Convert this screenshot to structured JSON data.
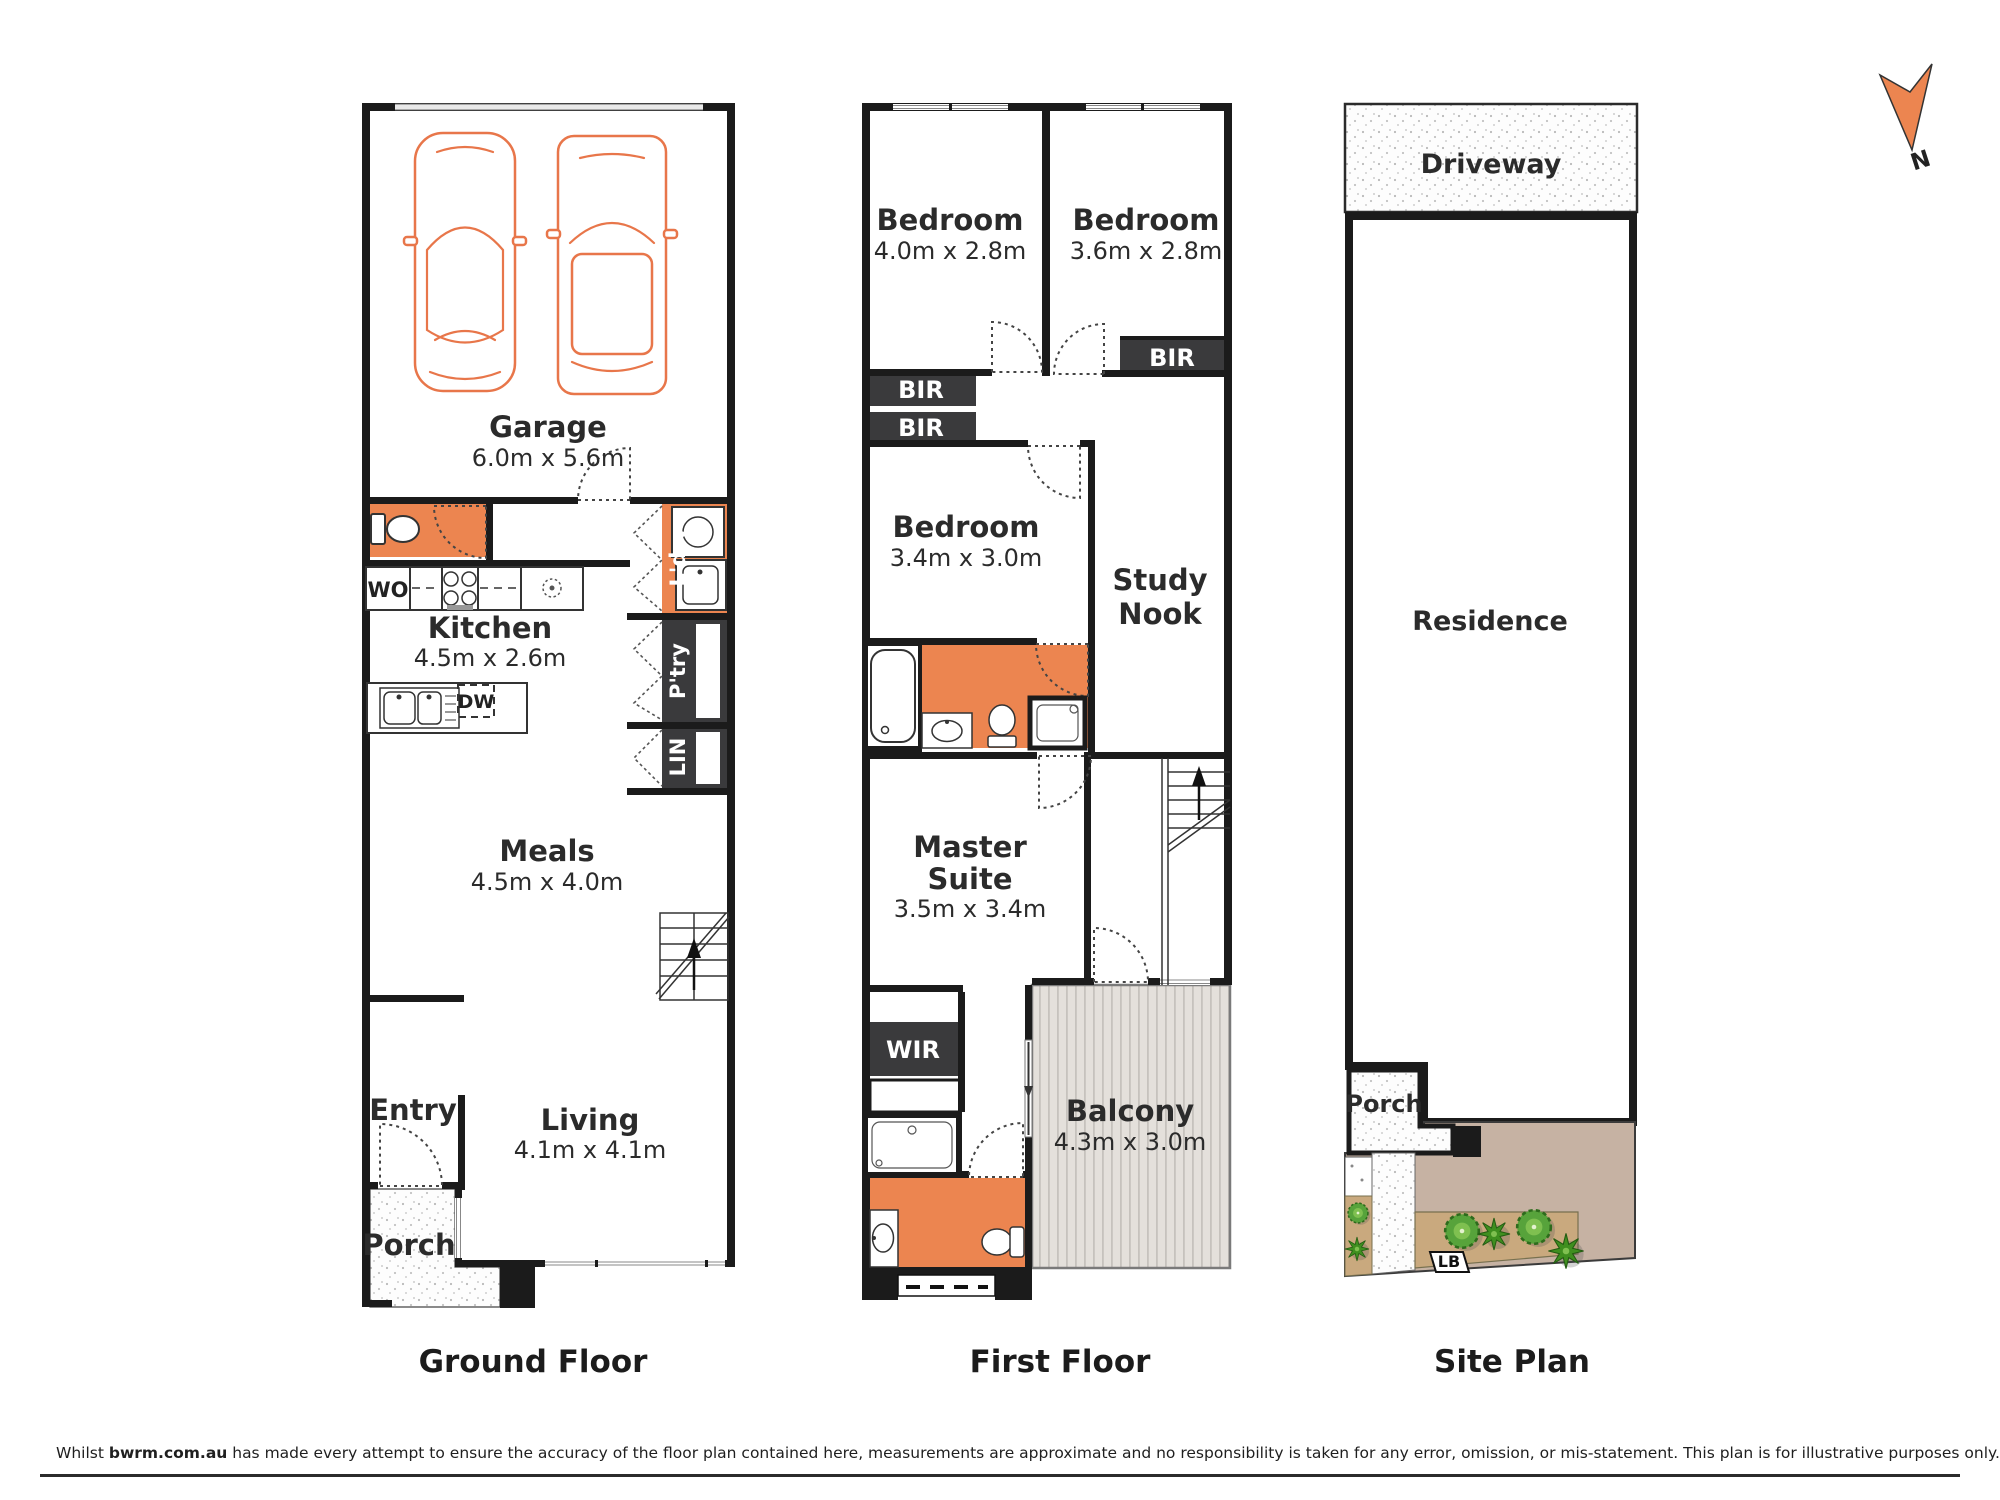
{
  "captions": {
    "ground": "Ground Floor",
    "first": "First Floor",
    "site": "Site Plan"
  },
  "compass": {
    "north": "N"
  },
  "ground": {
    "garage": {
      "name": "Garage",
      "dims": "6.0m x 5.6m"
    },
    "kitchen": {
      "name": "Kitchen",
      "dims": "4.5m x 2.6m"
    },
    "meals": {
      "name": "Meals",
      "dims": "4.5m x 4.0m"
    },
    "entry": {
      "name": "Entry"
    },
    "living": {
      "name": "Living",
      "dims": "4.1m x 4.1m"
    },
    "porch": {
      "name": "Porch"
    },
    "wall_oven": "WO",
    "dishwasher": "DW",
    "laundry": "L'dry",
    "pantry": "P'try",
    "linen": "LIN"
  },
  "first": {
    "bedroom2": {
      "name": "Bedroom",
      "dims": "4.0m x 2.8m"
    },
    "bedroom3": {
      "name": "Bedroom",
      "dims": "3.6m x 2.8m"
    },
    "bedroom4": {
      "name": "Bedroom",
      "dims": "3.4m x 3.0m"
    },
    "study_nook": {
      "line1": "Study",
      "line2": "Nook"
    },
    "master": {
      "line1": "Master",
      "line2": "Suite",
      "dims": "3.5m x 3.4m"
    },
    "balcony": {
      "name": "Balcony",
      "dims": "4.3m x 3.0m"
    },
    "bir": "BIR",
    "wir": "WIR"
  },
  "site": {
    "driveway": "Driveway",
    "residence": "Residence",
    "porch": "Porch",
    "letterbox": "LB"
  },
  "disclaimer": {
    "prefix": "Whilst ",
    "brand": "bwrm.com.au",
    "suffix": " has made every attempt to ensure the accuracy of the floor plan contained here, measurements are approximate and no responsibility is taken for any error, omission, or mis-statement. This plan is for illustrative purposes only."
  },
  "colors": {
    "accent_orange": "#ec8550",
    "car_outline": "#e8764a",
    "closet_dark": "#3a3a3c",
    "wall": "#1b1b1b",
    "balcony_fill": "#e3dfda",
    "garden_tan": "#c6b2a3",
    "garden_bed": "#c9a97e",
    "plant_green": "#4e9b31"
  }
}
